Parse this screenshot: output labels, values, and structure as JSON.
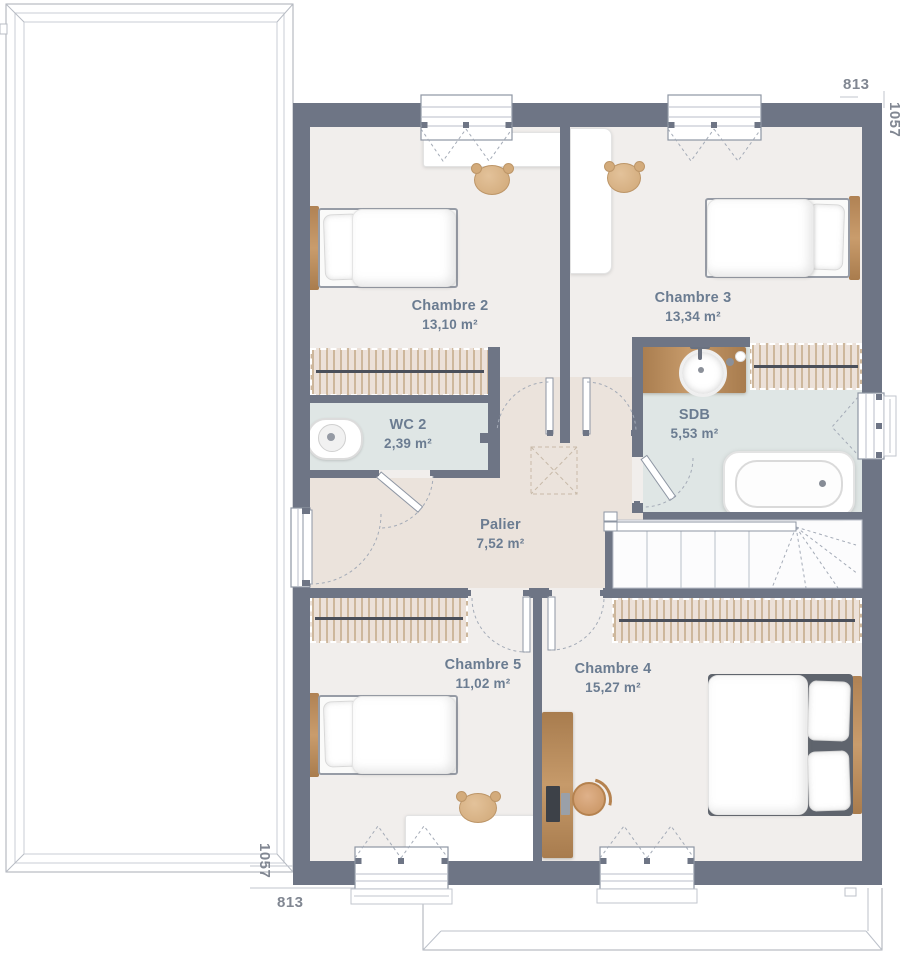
{
  "rooms": [
    {
      "name": "Chambre 2",
      "area": "13,10 m²"
    },
    {
      "name": "Chambre 3",
      "area": "13,34 m²"
    },
    {
      "name": "WC 2",
      "area": "2,39 m²"
    },
    {
      "name": "SDB",
      "area": "5,53 m²"
    },
    {
      "name": "Palier",
      "area": "7,52 m²"
    },
    {
      "name": "Chambre 5",
      "area": "11,02 m²"
    },
    {
      "name": "Chambre 4",
      "area": "15,27 m²"
    }
  ],
  "dimensions": {
    "top_width": "813",
    "right_height": "1057",
    "bottom_width": "813",
    "left_height": "1057"
  },
  "colors": {
    "wall": "#6e7585",
    "room_floor": "#f1eeec",
    "hall_floor": "#ebe3dc",
    "wet_floor": "#dfe6e5",
    "wood": "#b98e5f",
    "label_text": "#6b7c91",
    "dimension_text": "#818792"
  },
  "furniture_icons": [
    "single-bed",
    "single-bed",
    "single-bed",
    "double-bed",
    "desk",
    "desk",
    "desk",
    "wood-desk",
    "stool",
    "stool",
    "stool",
    "office-chair",
    "monitor",
    "toilet",
    "sink-vanity",
    "bathtub",
    "staircase",
    "wardrobe",
    "wardrobe",
    "wardrobe",
    "wardrobe",
    "skylight-hatch"
  ]
}
